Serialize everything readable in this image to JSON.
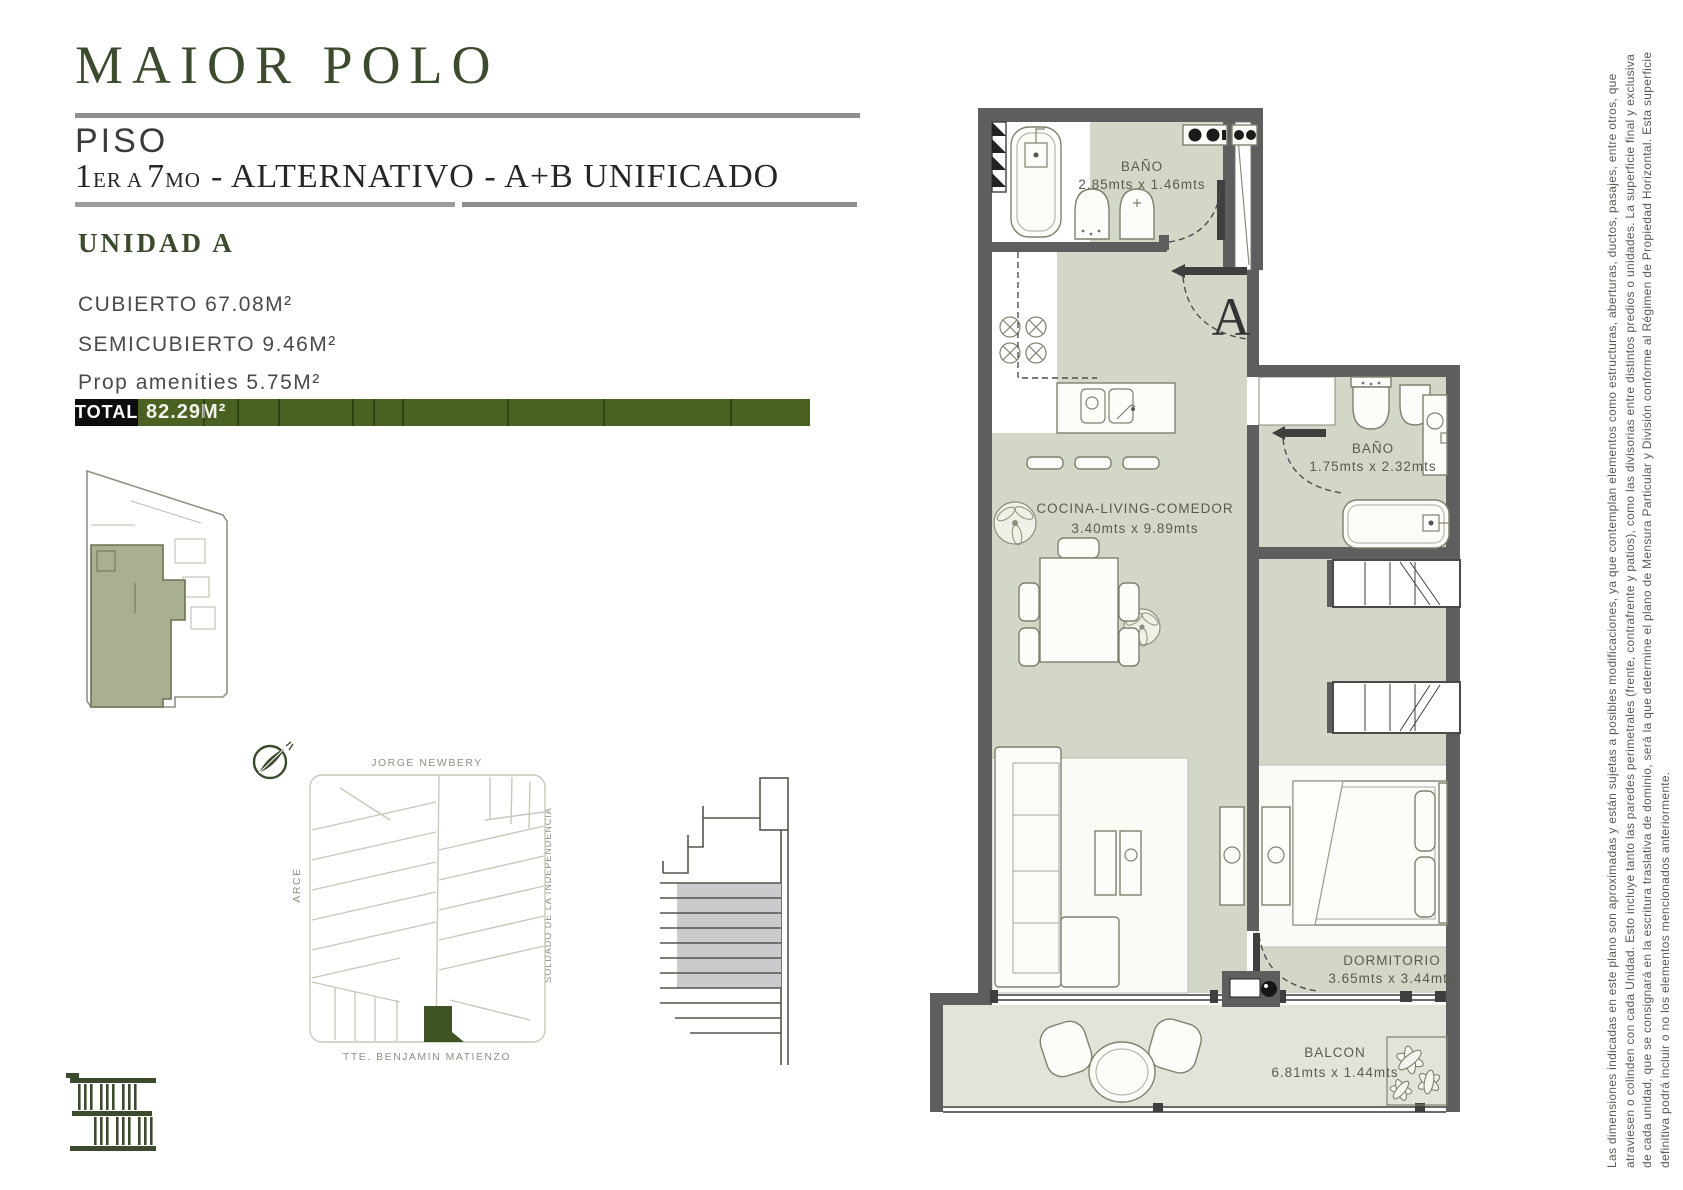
{
  "header": {
    "brand": "MAIOR POLO",
    "floor_label": "PISO",
    "sub_num1": "1",
    "sub_small1": "ER A",
    "sub_num2": "7",
    "sub_small2": "MO",
    "sub_rest": "- ALTERNATIVO - A+B UNIFICADO"
  },
  "unit": {
    "name": "UNIDAD A",
    "areas": [
      "CUBIERTO 67.08M²",
      "SEMICUBIERTO 9.46M²",
      "Prop amenities 5.75M²"
    ],
    "total_label": "TOTAL",
    "total_value": "82.29M²"
  },
  "plan": {
    "unit_letter": "A",
    "rooms": {
      "bano1_name": "BAÑO",
      "bano1_dims": "2.85mts x 1.46mts",
      "cocina_name": "COCINA-LIVING-COMEDOR",
      "cocina_dims": "3.40mts x 9.89mts",
      "bano2_name": "BAÑO",
      "bano2_dims": "1.75mts x 2.32mts",
      "dorm_name": "DORMITORIO",
      "dorm_dims": "3.65mts x 3.44mts",
      "balcon_name": "BALCON",
      "balcon_dims": "6.81mts x 1.44mts"
    }
  },
  "map": {
    "street_top": "JORGE NEWBERY",
    "street_left": "ARCE",
    "street_right": "SOLDADO DE LA INDEPENDENCIA",
    "street_bottom": "TTE. BENJAMIN MATIENZO"
  },
  "disclaimer": {
    "line1": "Las dimensiones indicadas en este plano son aproximadas y están sujetas a posibles modificaciones, ya que contemplan elementos como estructuras, aberturas, ductos, pasajes, entre otros, que",
    "line2": "atraviesen o colinden con cada Unidad. Esto incluye tanto las paredes perimetrales (frente, contrafrente y patios), como las divisorias entre distintos predios o unidades. La superficie final y exclusiva",
    "line3": "de cada unidad, que se consignará en la escritura traslativa de dominio, será la que determine el plano de Mensura Particular y División conforme al Régimen de Propiedad Horizontal. Esta superficie",
    "line4": "definitiva podrá incluir o no los elementos mencionados anteriormente."
  },
  "colors": {
    "brand_green": "#3c4b2e",
    "bar_green": "#4b6121",
    "wall_gray": "#5e5e5e",
    "plan_green": "#d2d7c7",
    "balcony_green": "#e1e4d9",
    "lot_green": "#3f5422"
  }
}
